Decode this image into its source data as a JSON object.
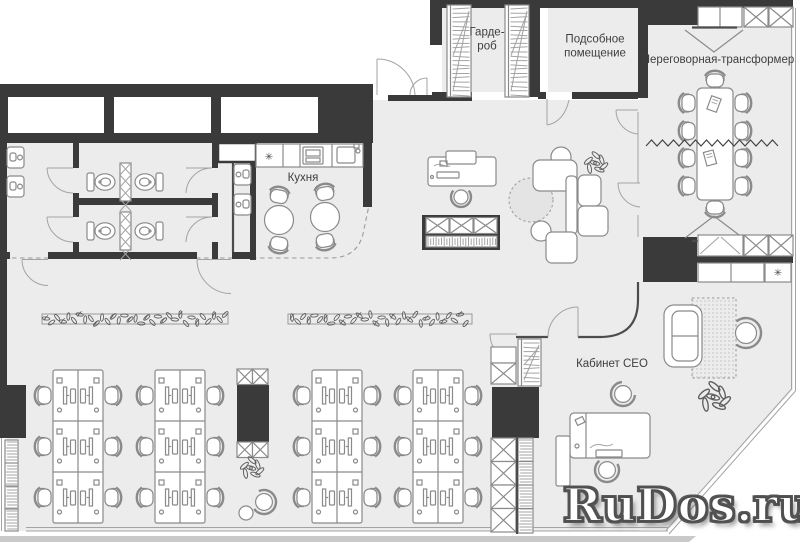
{
  "rooms": {
    "wardrobe": {
      "line1": "Гарде-",
      "line2": "роб"
    },
    "utility": {
      "line1": "Подсобное",
      "line2": "помещение"
    },
    "meeting": {
      "label": "Переговорная-трансформер"
    },
    "kitchen": {
      "label": "Кухня"
    },
    "ceo": {
      "label": "Кабинет CEO"
    }
  },
  "symbols": {
    "asterisk": "✳"
  },
  "watermark": {
    "text": "RuDos.ru"
  },
  "colors": {
    "wall": "#3a3a3a",
    "floor": "#ececec",
    "furniture_line": "#8a8a8a",
    "label": "#3e3e3e",
    "watermark_fill": "#ffffff",
    "watermark_outline": "#4f4f4f",
    "exterior_band": "#c9c9c9"
  }
}
